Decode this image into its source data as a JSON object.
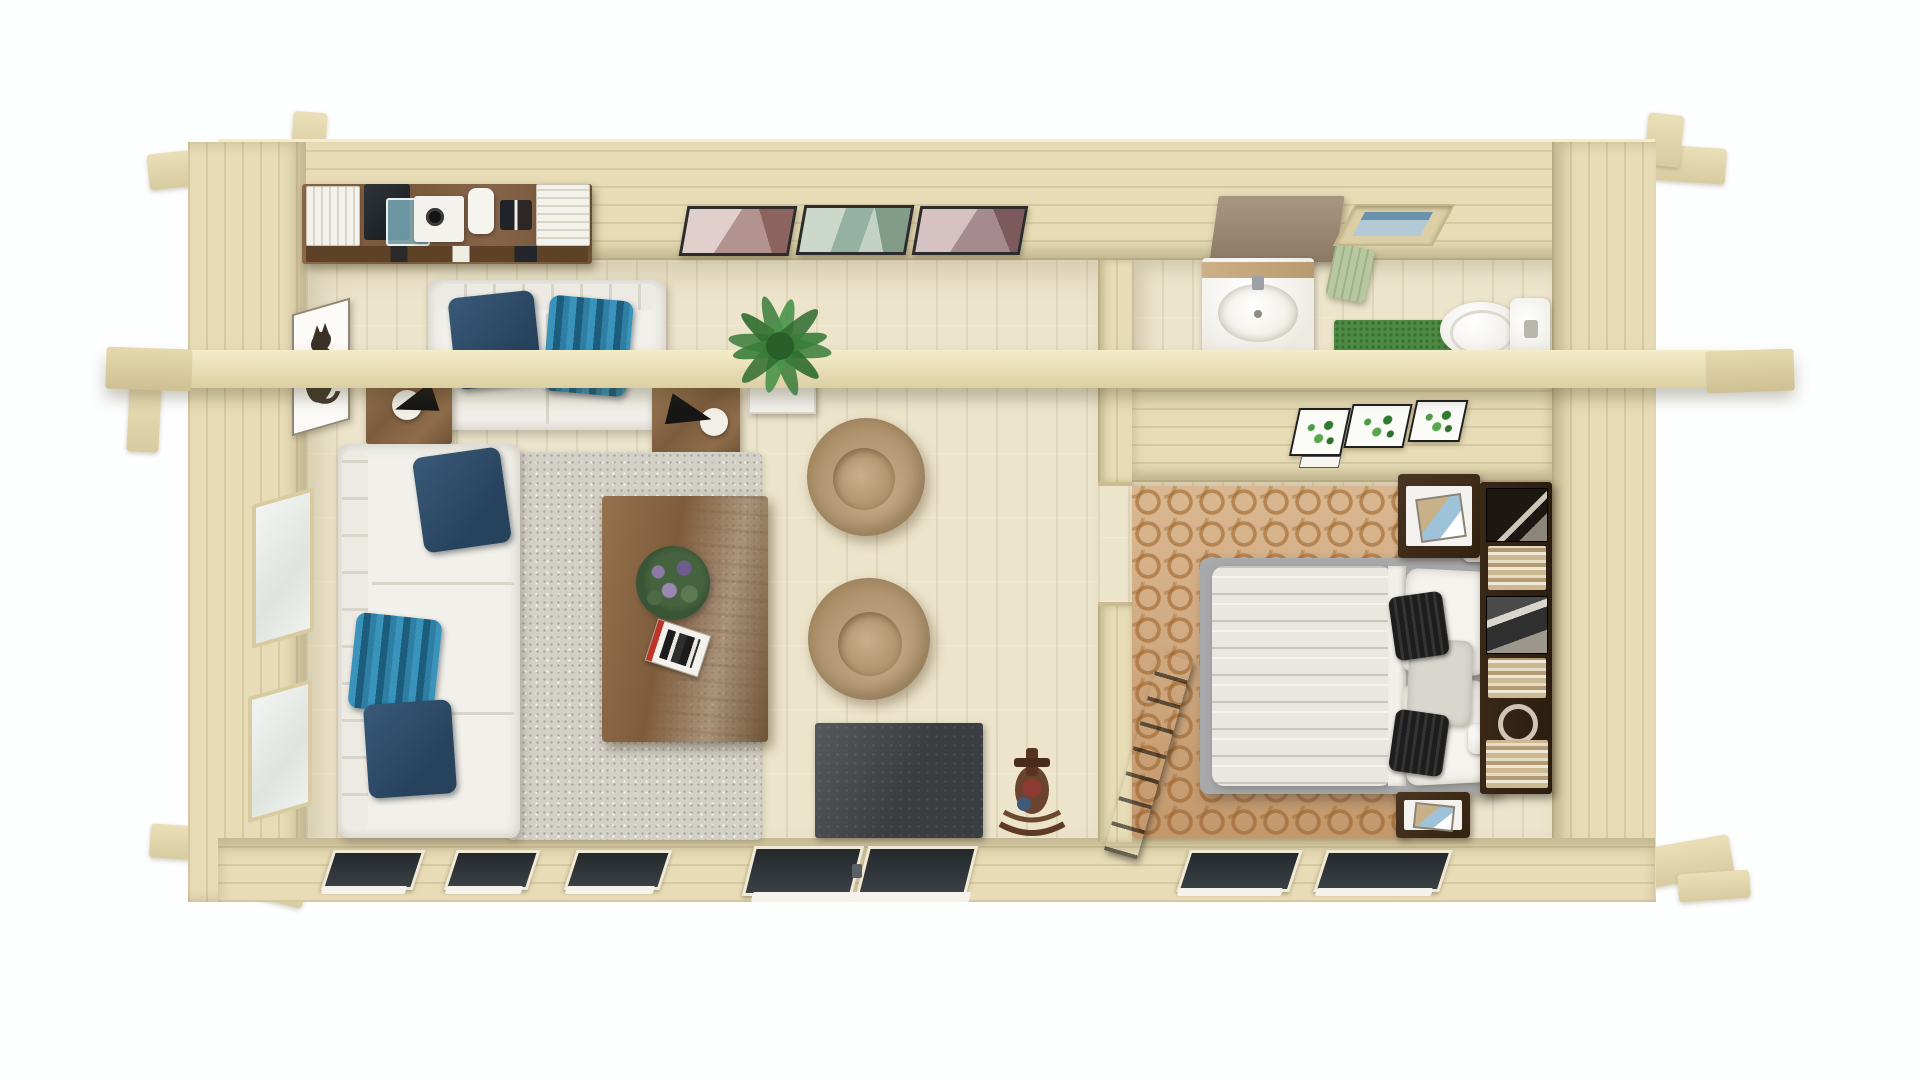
{
  "scene": {
    "title": "Top-down 3D render of a one-bedroom log cabin floor plan",
    "background_color": "#ffffff",
    "view": "aerial cutaway, no roof, exposed collar beam across full width",
    "text_on_screen": "none"
  },
  "structure": {
    "walls": {
      "material": "light natural spruce logs",
      "color": "#e7dcb6",
      "corner_log_ends": true
    },
    "collar_beam": {
      "label": "exposed ceiling beam spanning cabin",
      "color": "#f0e5c2"
    },
    "partition": {
      "label": "interior partition wall with bedroom doorway opening"
    },
    "openings": {
      "living_south_windows": 3,
      "living_south_door": "double glass patio door with threshold",
      "bedroom_south_windows": 2,
      "west_wall_windows": 2,
      "bathroom_skylight": 1
    }
  },
  "rooms": {
    "living_room": {
      "label": "Living room",
      "floor_color": "#ece4cb",
      "items": [
        "wall-mounted desk shelf with white book stacks, laptop, camera tray, figurines and gadgets",
        "three framed mountain art prints on north wall",
        "white loveseat with navy and teal-striped cushions",
        "two walnut side tables with black cone lamps",
        "white corner sofa with navy and teal-striped cushions",
        "gray shag rug",
        "walnut coffee table with flower bouquet and magazine",
        "potted palm plant in white planter",
        "two beige bean bag chairs",
        "charcoal area rug",
        "wooden toy rocking horse",
        "framed cat picture on west wall"
      ]
    },
    "bathroom": {
      "label": "Bathroom",
      "items": [
        "wall cabinet above basin",
        "white washbasin with wooden shelf and faucet",
        "sage hanging towel",
        "roof skylight window",
        "green bath mat",
        "white toilet with cistern"
      ]
    },
    "bedroom": {
      "label": "Bedroom",
      "items": [
        "three framed botanical prints with small caption card",
        "terracotta chain-pattern rug",
        "double bed with quilted duvet, white sheets, two white pillows, two black accent pillows, one gray pillow and headboard bolster",
        "two white bedside lamps",
        "two dark-wood nightstands with white drawer fronts and framed decor",
        "tall dark bookshelf with books, framed photos and ornaments along east wall",
        "dark wooden ladder leaning on partition wall"
      ]
    }
  },
  "palette": {
    "wall_wood": "#e7dcb6",
    "beam_wood": "#f0e5c2",
    "floor_living": "#ece4cb",
    "walnut": "#7d5c3e",
    "sofa_white": "#f2f0ea",
    "pillow_navy": "#2d4a66",
    "pillow_teal_stripe": "#2f7fa4",
    "rug_gray": "#d3d0c8",
    "rug_charcoal": "#3b3e41",
    "bean_bag_tan": "#b29772",
    "rug_bedroom_terracotta": "#cfa67c",
    "bed_duvet": "#e9e7e0",
    "nightstand_wood": "#42301f",
    "bath_mat_green": "#4d8a42",
    "towel_sage": "#b7c7a0",
    "plant_green": "#3a7d39",
    "skylight_glass": "#b3c9d6",
    "glass_dark": "#2b3134"
  }
}
